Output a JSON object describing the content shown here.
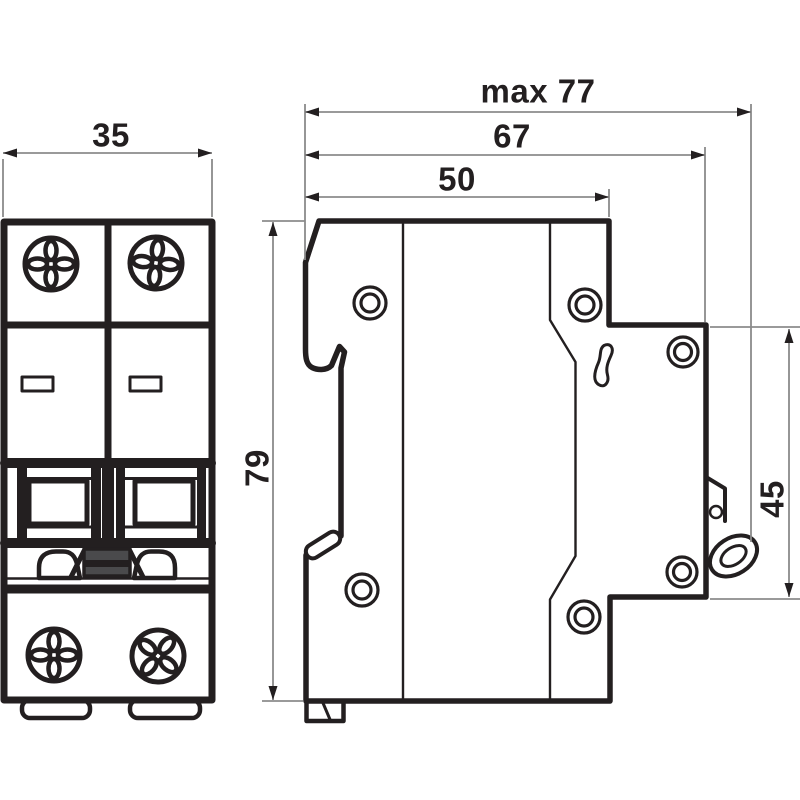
{
  "drawing": {
    "dimension_labels": {
      "front_width": "35",
      "max_depth": "max 77",
      "body_depth": "67",
      "top_depth": "50",
      "height": "79",
      "right_height": "45"
    },
    "colors": {
      "line": "#231f20",
      "dimension_line": "#8b8b8b",
      "handle_fill": "#4a4a4c",
      "background": "#ffffff"
    }
  }
}
